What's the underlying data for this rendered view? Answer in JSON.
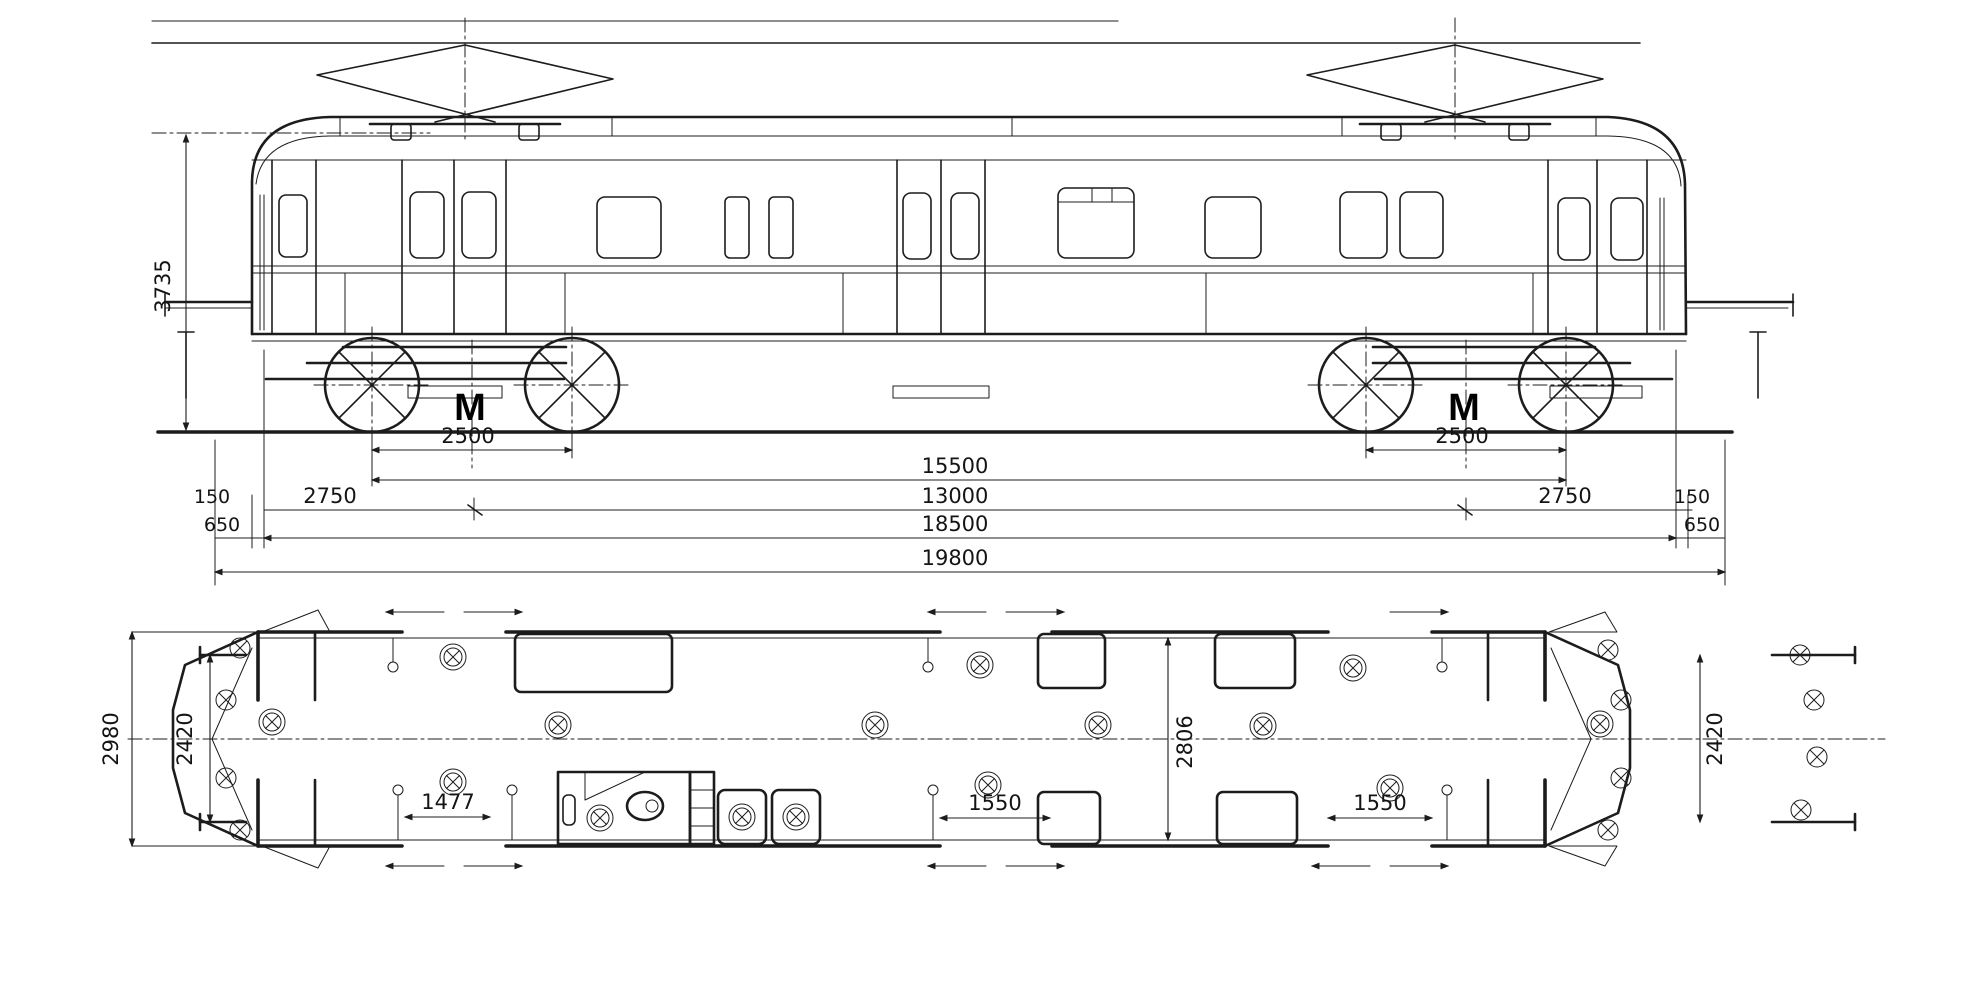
{
  "drawing": {
    "subject": "Electric motor coach works drawing — side elevation and floor plan with dimensions",
    "colors": {
      "ink": "#1c1c1c",
      "paper": "#ffffff"
    }
  },
  "side": {
    "dims": {
      "height": "3735",
      "axle_base_left": "2500",
      "axle_base_right": "2500",
      "outer_axles": "15500",
      "bogie_centres": "13000",
      "overhang_left": "2750",
      "overhang_right": "2750",
      "headstock_left": "150",
      "headstock_right": "150",
      "buffer_left": "650",
      "buffer_right": "650",
      "body_length": "18500",
      "total_length": "19800"
    },
    "bogies": {
      "left_mark": "M",
      "right_mark": "M"
    }
  },
  "plan": {
    "dims": {
      "overall_width": "2980",
      "end_width_left": "2420",
      "end_width_right": "2420",
      "body_width": "2806",
      "door_left": "1477",
      "door_centre": "1550",
      "door_right": "1550"
    }
  }
}
